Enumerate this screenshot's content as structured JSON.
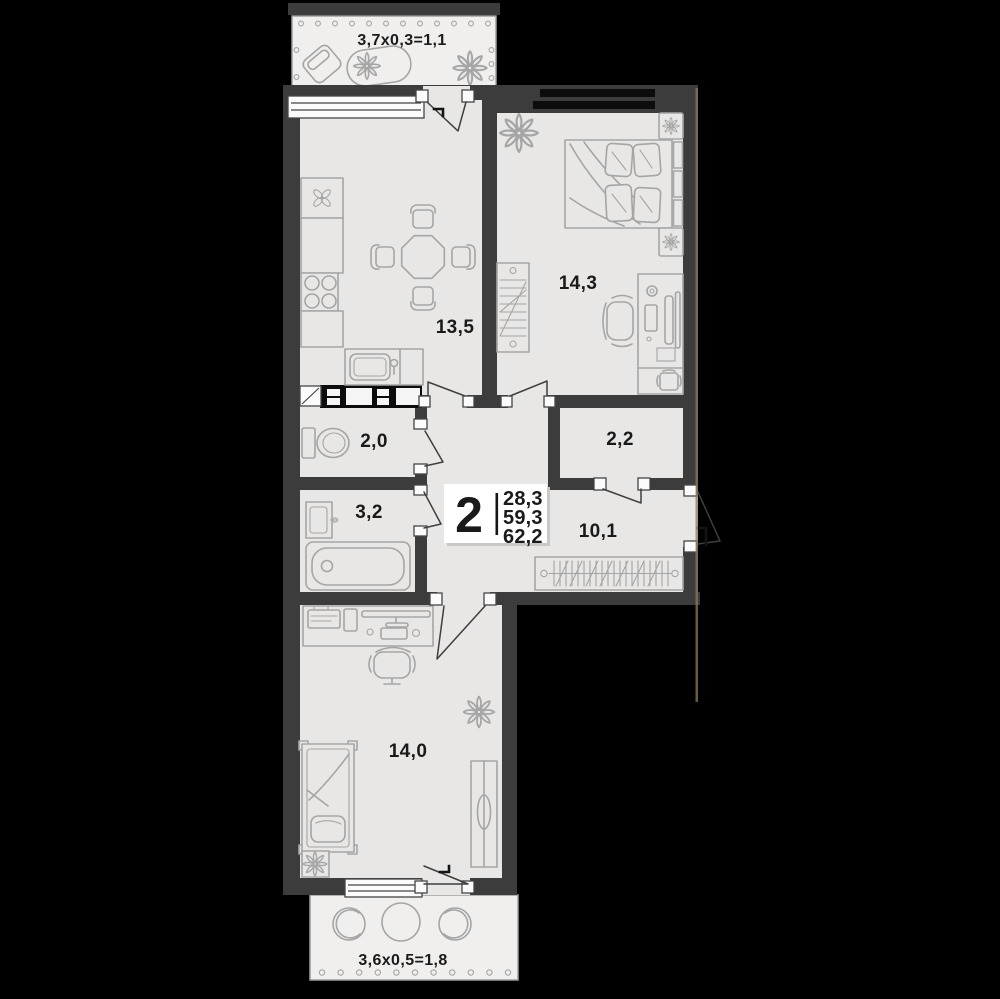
{
  "plan": {
    "info_box": {
      "room_count": "2",
      "areas": {
        "living": "28,3",
        "apartment": "59,3",
        "total": "62,2"
      }
    },
    "rooms": {
      "kitchen": {
        "area": "13,5"
      },
      "bedroom": {
        "area": "14,3"
      },
      "wc": {
        "area": "2,0"
      },
      "storage": {
        "area": "2,2"
      },
      "bathroom": {
        "area": "3,2"
      },
      "hallway": {
        "area": "10,1"
      },
      "bedroom2": {
        "area": "14,0"
      }
    },
    "balconies": {
      "top": {
        "label": "3,7x0,3=1,1"
      },
      "bottom": {
        "label": "3,6x0,5=1,8"
      }
    },
    "colors": {
      "background": "#000000",
      "wall": "#3d3c3c",
      "floor": "#e8e7e6",
      "balcony_floor": "#f0efee",
      "furniture_line": "#a5a5a5",
      "window_glass": "#0c0c0c",
      "text": "#1a1a1a",
      "info_box_bg": "#ffffff",
      "accent_edge": "#8b7c4e"
    }
  }
}
